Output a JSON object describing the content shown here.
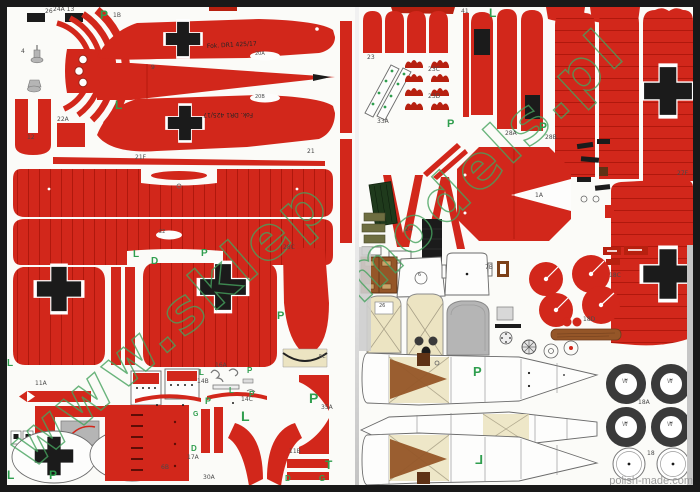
{
  "fuselage_marking": "Fok. DR1 425/17",
  "watermarks": {
    "left": "www.sklep",
    "right": "models.pl"
  },
  "footer": "polish-made.com",
  "colors": {
    "red": "#d2271b",
    "red_dark": "#a81409",
    "red_deep": "#b7200f",
    "black": "#1b1b1b",
    "green": "#2f9e4e",
    "wm": "#46a35e",
    "cream": "#ece4c2",
    "brown": "#955628",
    "brown_dark": "#5f3215",
    "gray_part": "#b5b5b5",
    "olive": "#6e6e41",
    "dark_green": "#1f3a1c",
    "tire": "#3a3a3a",
    "label": "#4a4a4a",
    "footer": "#9b9b9b",
    "paper": "#fbfbf8",
    "border": "#191919"
  },
  "left_page": {
    "labels": [
      {
        "t": "P",
        "x": 93,
        "y": 2,
        "g": 1,
        "s": 12
      },
      {
        "t": "1B",
        "x": 106,
        "y": 6
      },
      {
        "t": "26",
        "x": 38,
        "y": 2
      },
      {
        "t": "24A 13",
        "x": 46,
        "y": 0
      },
      {
        "t": "4",
        "x": 14,
        "y": 42
      },
      {
        "t": "12",
        "x": 20,
        "y": 128
      },
      {
        "t": "22A",
        "x": 50,
        "y": 110
      },
      {
        "t": "20A",
        "x": 248,
        "y": 45,
        "s": 5
      },
      {
        "t": "9",
        "x": 144,
        "y": 58
      },
      {
        "t": "L",
        "x": 108,
        "y": 92,
        "g": 1,
        "s": 12
      },
      {
        "t": "20B",
        "x": 248,
        "y": 88,
        "s": 5
      },
      {
        "t": "21",
        "x": 300,
        "y": 142
      },
      {
        "t": "21F",
        "x": 128,
        "y": 148
      },
      {
        "t": "22",
        "x": 152,
        "y": 223,
        "s": 5
      },
      {
        "t": "L",
        "x": 126,
        "y": 243,
        "g": 1,
        "s": 10
      },
      {
        "t": "D",
        "x": 144,
        "y": 250,
        "g": 1,
        "s": 10
      },
      {
        "t": "P",
        "x": 194,
        "y": 242,
        "g": 1,
        "s": 10
      },
      {
        "t": "L",
        "x": 0,
        "y": 352,
        "g": 1,
        "s": 10
      },
      {
        "t": "28C",
        "x": 276,
        "y": 238
      },
      {
        "t": "P",
        "x": 270,
        "y": 304,
        "g": 1,
        "s": 11
      },
      {
        "t": "5C",
        "x": 312,
        "y": 348,
        "s": 5
      },
      {
        "t": "11A",
        "x": 28,
        "y": 374
      },
      {
        "t": "L",
        "x": 192,
        "y": 362,
        "g": 1,
        "s": 8
      },
      {
        "t": "16A",
        "x": 208,
        "y": 356
      },
      {
        "t": "P",
        "x": 240,
        "y": 360,
        "g": 1,
        "s": 8
      },
      {
        "t": "L",
        "x": 222,
        "y": 380,
        "g": 1,
        "s": 8
      },
      {
        "t": "14B",
        "x": 190,
        "y": 372
      },
      {
        "t": "P",
        "x": 242,
        "y": 384,
        "g": 1,
        "s": 8
      },
      {
        "t": "14C",
        "x": 234,
        "y": 390
      },
      {
        "t": "P",
        "x": 198,
        "y": 390,
        "g": 1,
        "s": 9
      },
      {
        "t": "G",
        "x": 186,
        "y": 404,
        "g": 1,
        "s": 7
      },
      {
        "t": "D",
        "x": 184,
        "y": 438,
        "g": 1,
        "s": 8
      },
      {
        "t": "17A",
        "x": 180,
        "y": 448
      },
      {
        "t": "L",
        "x": 234,
        "y": 402,
        "g": 1,
        "s": 14
      },
      {
        "t": "30A",
        "x": 196,
        "y": 468
      },
      {
        "t": "P",
        "x": 302,
        "y": 384,
        "g": 1,
        "s": 14
      },
      {
        "t": "35A",
        "x": 314,
        "y": 398
      },
      {
        "t": "11B",
        "x": 282,
        "y": 442
      },
      {
        "t": "T",
        "x": 318,
        "y": 452,
        "g": 1,
        "s": 12
      },
      {
        "t": "D",
        "x": 278,
        "y": 468,
        "g": 1,
        "s": 8
      },
      {
        "t": "G",
        "x": 312,
        "y": 468,
        "g": 1,
        "s": 8
      },
      {
        "t": "L",
        "x": 0,
        "y": 462,
        "g": 1,
        "s": 12
      },
      {
        "t": "P",
        "x": 42,
        "y": 462,
        "g": 1,
        "s": 12
      },
      {
        "t": "6B",
        "x": 154,
        "y": 458
      }
    ]
  },
  "right_page": {
    "labels": [
      {
        "t": "L",
        "x": 130,
        "y": 0,
        "g": 1,
        "s": 12
      },
      {
        "t": "41",
        "x": 102,
        "y": 2
      },
      {
        "t": "23",
        "x": 8,
        "y": 48
      },
      {
        "t": "33A",
        "x": 18,
        "y": 112
      },
      {
        "t": "23C",
        "x": 69,
        "y": 60
      },
      {
        "t": "23D",
        "x": 69,
        "y": 87
      },
      {
        "t": "P",
        "x": 180,
        "y": 114,
        "g": 1,
        "s": 12
      },
      {
        "t": "P",
        "x": 88,
        "y": 112,
        "g": 1,
        "s": 11
      },
      {
        "t": "28A",
        "x": 146,
        "y": 124
      },
      {
        "t": "28B",
        "x": 186,
        "y": 128
      },
      {
        "t": "1A",
        "x": 176,
        "y": 186
      },
      {
        "t": "24",
        "x": 46,
        "y": 220
      },
      {
        "t": "27F",
        "x": 318,
        "y": 164
      },
      {
        "t": "18C",
        "x": 250,
        "y": 266
      },
      {
        "t": "18D",
        "x": 224,
        "y": 310
      },
      {
        "t": "7B",
        "x": 126,
        "y": 258
      },
      {
        "t": "6",
        "x": 59,
        "y": 266,
        "s": 5
      },
      {
        "t": "26",
        "x": 20,
        "y": 297,
        "s": 5
      },
      {
        "t": "P",
        "x": 114,
        "y": 358,
        "g": 1,
        "s": 13
      },
      {
        "t": "L",
        "x": 116,
        "y": 446,
        "g": 1,
        "s": 13,
        "m": 1
      },
      {
        "t": "W",
        "x": 263,
        "y": 372,
        "s": 6,
        "c": "#7a7a7a"
      },
      {
        "t": "W",
        "x": 308,
        "y": 372,
        "s": 6,
        "c": "#7a7a7a"
      },
      {
        "t": "W",
        "x": 263,
        "y": 415,
        "s": 6,
        "c": "#7a7a7a"
      },
      {
        "t": "W",
        "x": 308,
        "y": 415,
        "s": 6,
        "c": "#7a7a7a"
      },
      {
        "t": "18A",
        "x": 279,
        "y": 393
      },
      {
        "t": "18",
        "x": 288,
        "y": 444
      }
    ]
  }
}
